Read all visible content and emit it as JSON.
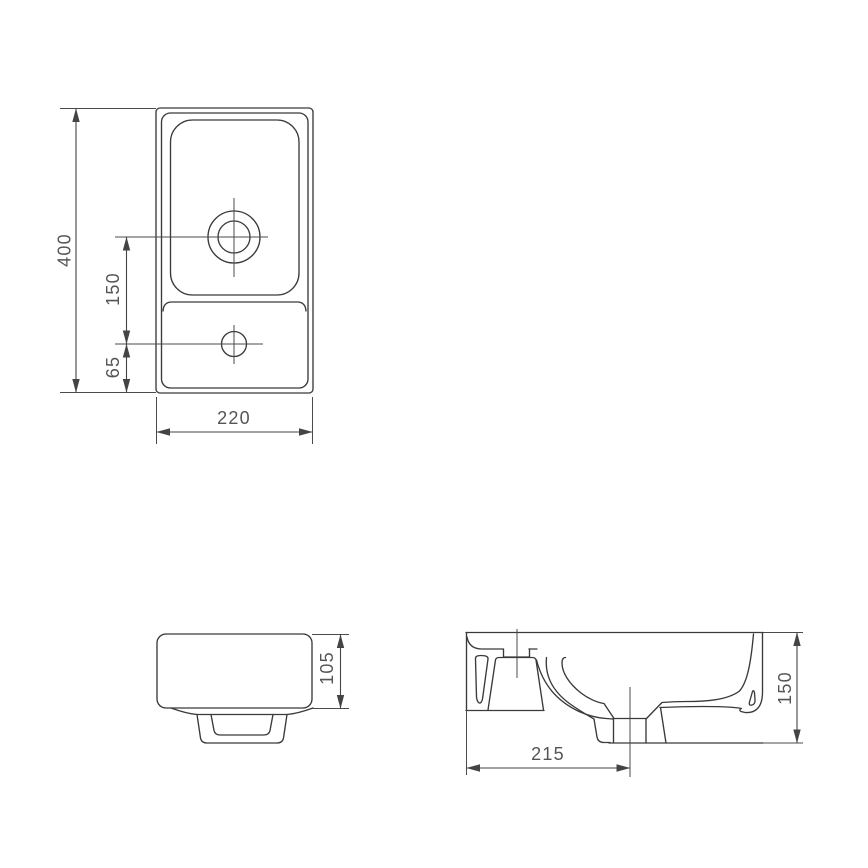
{
  "document": {
    "type": "technical dimensional drawing",
    "subject": "wall-hung washbasin, three orthographic views",
    "background_color": "#ffffff",
    "line_color": "#3a3a3a",
    "dimension_line_color": "#444444",
    "label_color": "#555555"
  },
  "views": {
    "plan": {
      "name": "top view (plan)",
      "dimensions": {
        "depth": "400",
        "drain_to_tap": "150",
        "tap_to_front_edge": "65",
        "width": "220"
      }
    },
    "side": {
      "name": "side view",
      "dimensions": {
        "body_height": "105"
      }
    },
    "section": {
      "name": "cross-section view",
      "dimensions": {
        "left_edge_to_drain": "215",
        "overall_height": "150"
      }
    }
  }
}
